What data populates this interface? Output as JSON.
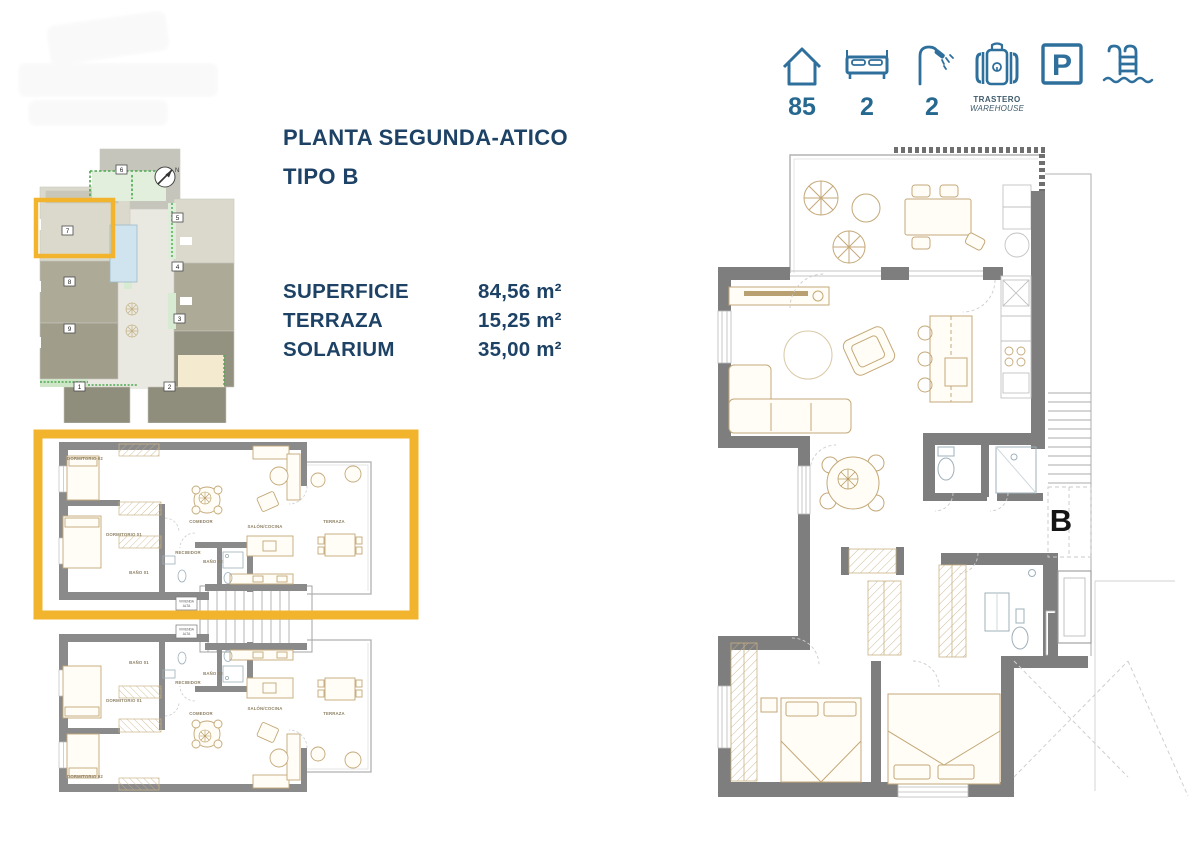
{
  "title_block": {
    "line1": "PLANTA SEGUNDA-ATICO",
    "line2": "TIPO B"
  },
  "areas_table": {
    "rows": [
      {
        "label": "SUPERFICIE",
        "value": "84,56 m²"
      },
      {
        "label": "TERRAZA",
        "value": "15,25 m²"
      },
      {
        "label": "SOLARIUM",
        "value": "35,00 m²"
      }
    ]
  },
  "amenities": {
    "house": {
      "icon": "house-icon",
      "value": "85"
    },
    "bedrooms": {
      "icon": "bed-icon",
      "value": "2"
    },
    "bathrooms": {
      "icon": "shower-icon",
      "value": "2"
    },
    "storage": {
      "icon": "storage-icon",
      "line1": "TRASTERO",
      "line2": "WAREHOUSE"
    },
    "parking": {
      "icon": "parking-icon",
      "letter": "P"
    },
    "pool": {
      "icon": "pool-icon"
    }
  },
  "site_plan": {
    "highlighted_unit": "7",
    "compass_label": "N",
    "units": {
      "u1": "1",
      "u2": "2",
      "u3": "3",
      "u4": "4",
      "u5": "5",
      "u6": "6",
      "u7": "7",
      "u8": "8",
      "u9": "9"
    }
  },
  "unit_plan": {
    "rooms": {
      "dormitorio2": "DORMITORIO 02",
      "dormitorio1": "DORMITORIO 01",
      "bano1": "BAÑO 01",
      "bano2": "BAÑO 02",
      "recibidor": "RECIBIDOR",
      "comedor": "COMEDOR",
      "salon_cocina": "SALÓN/COCINA",
      "terraza": "TERRAZA"
    },
    "stair_box_line1": "VIVIENDA",
    "stair_box_line2": "ALTA"
  },
  "main_plan": {
    "type_label": "B"
  },
  "colors": {
    "accent_blue": "#2E6F9C",
    "navy": "#1D4265",
    "highlight_yellow": "#F2B42C",
    "wall_gray": "#7E7E7E",
    "furniture_tan": "#C4A878"
  }
}
